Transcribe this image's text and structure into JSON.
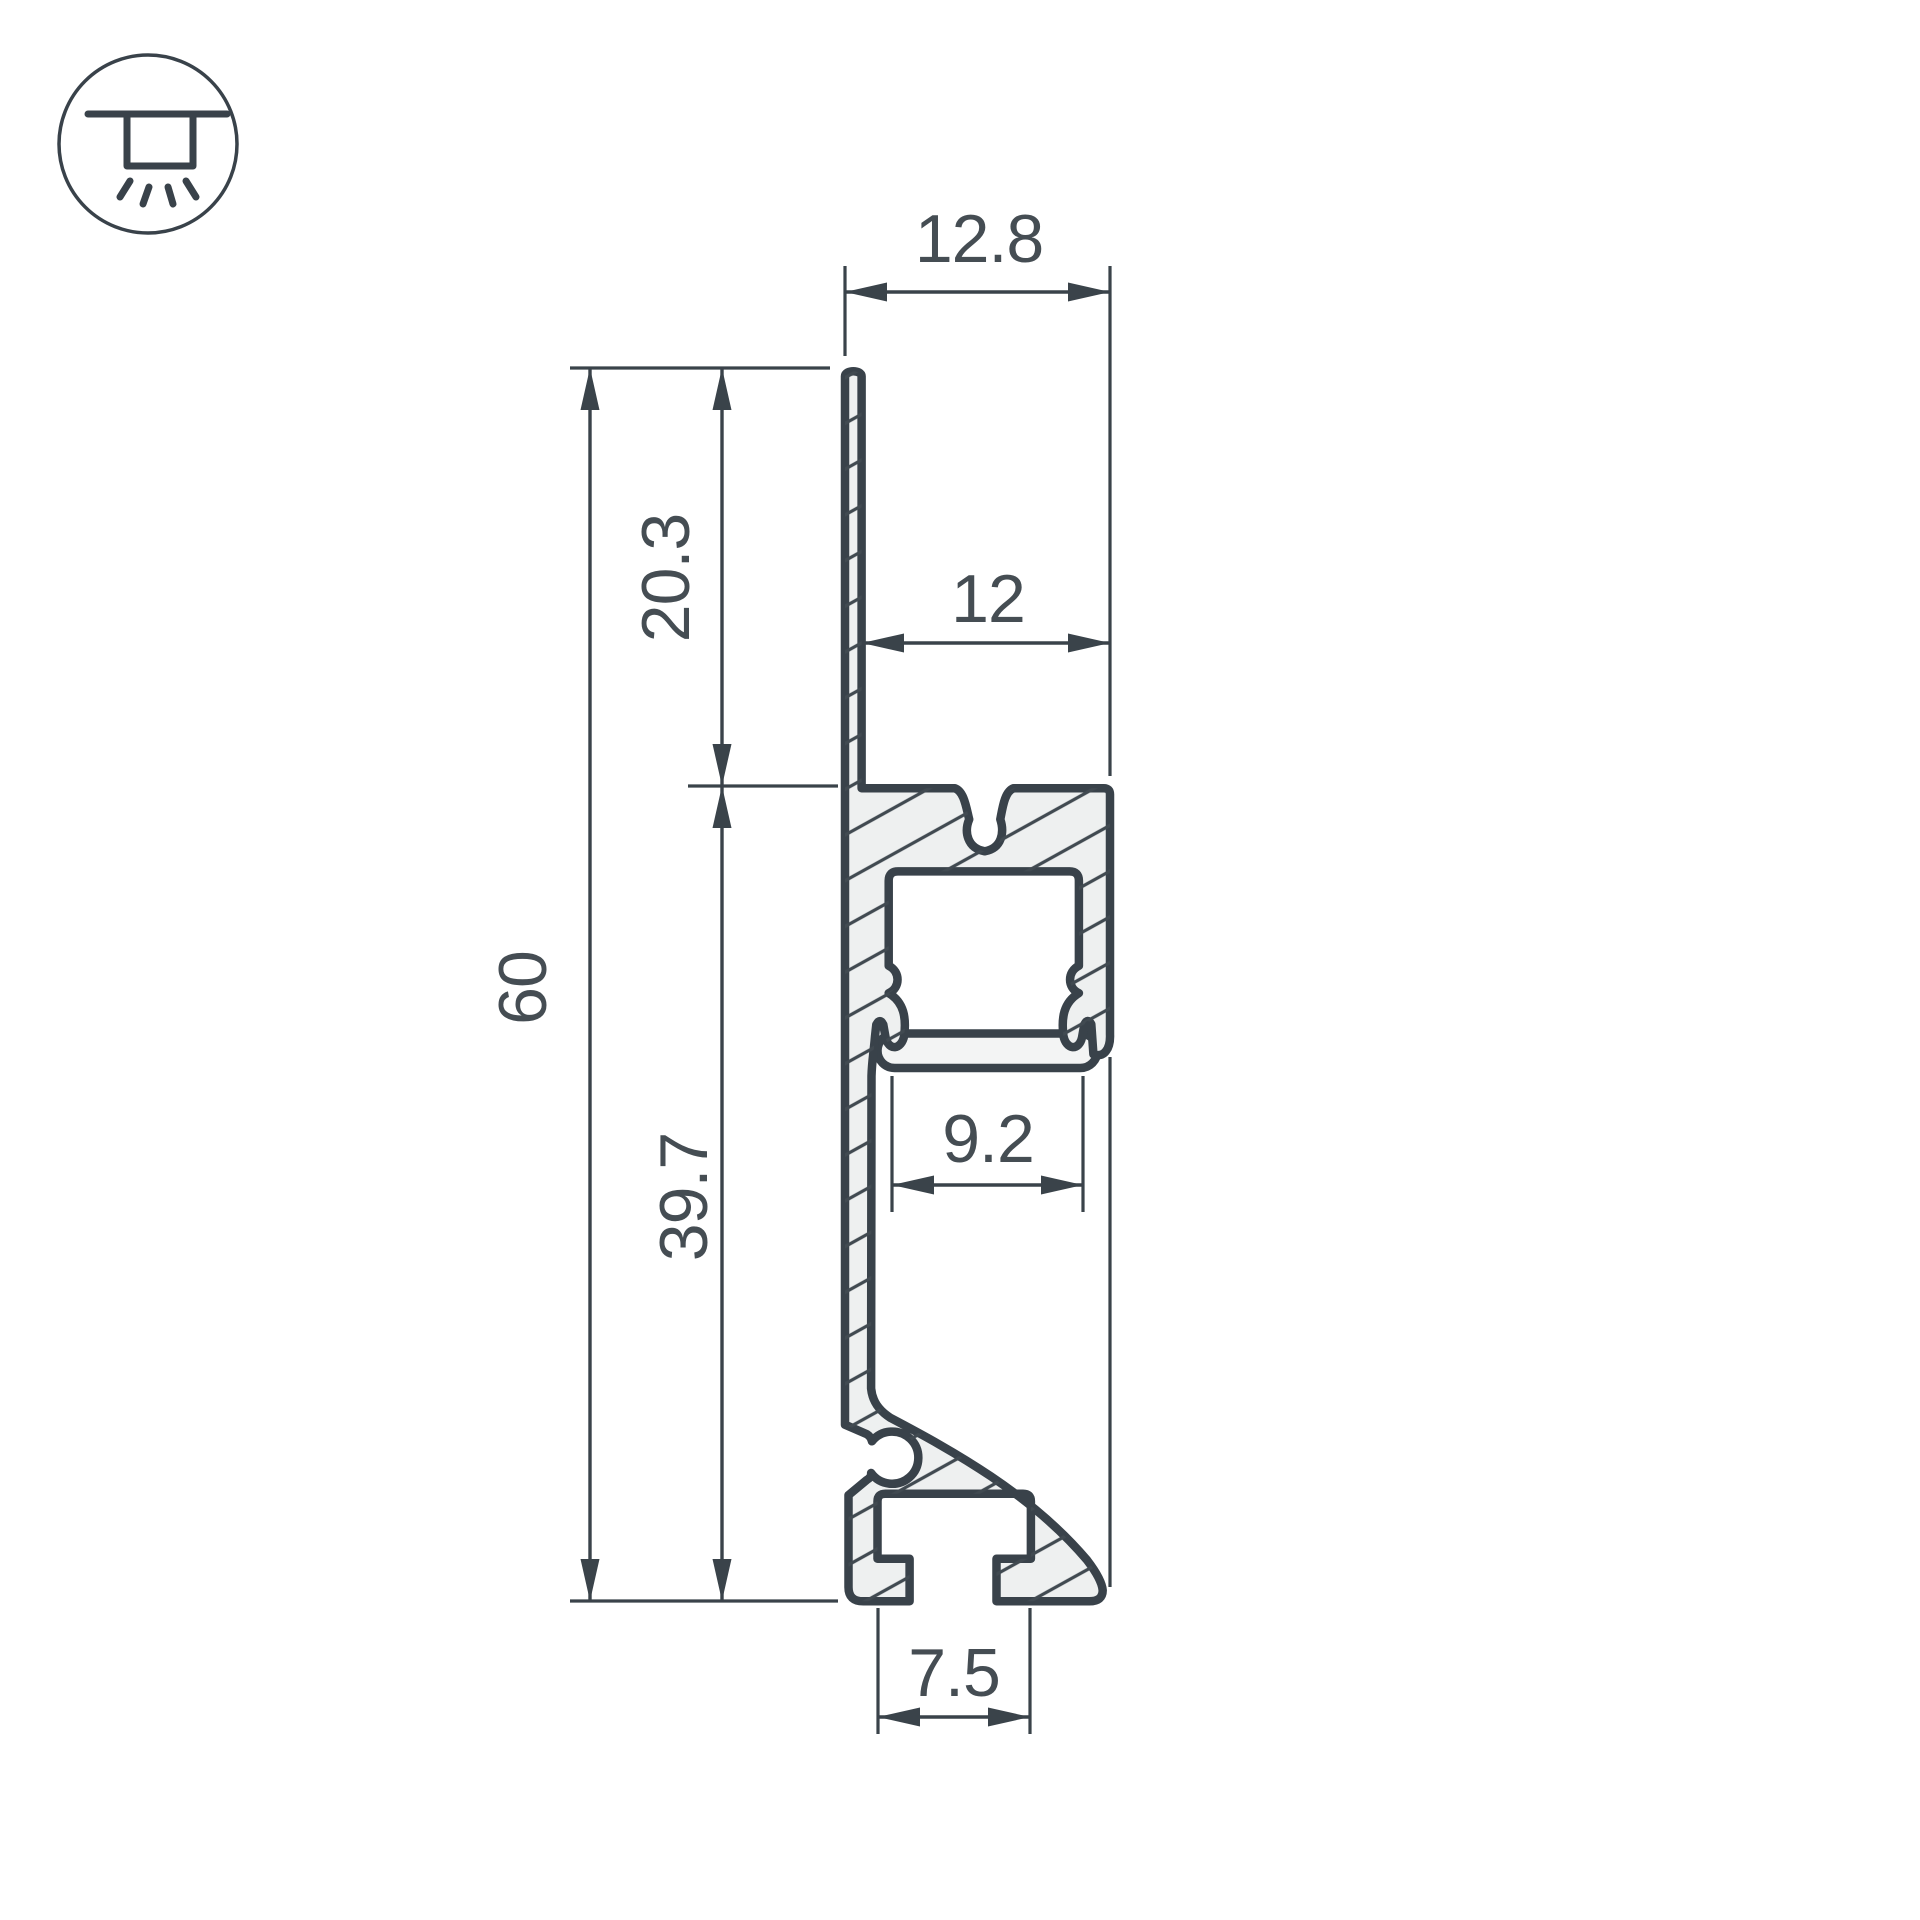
{
  "meta": {
    "type": "technical-drawing",
    "subject": "aluminium LED plinth profile cross-section"
  },
  "colors": {
    "ink": "#3a434a",
    "body_fill": "#eef0f0",
    "diffuser_fill": "#f3f4f4",
    "text": "#454d53",
    "background": "#ffffff"
  },
  "icon": {
    "name": "recessed-downlight-icon",
    "meaning": "downward light emission"
  },
  "dims": {
    "overall_width": "12.8",
    "channel_top_width": "12",
    "overall_height": "60",
    "upper_height": "20.3",
    "lower_height": "39.7",
    "channel_inner_width": "9.2",
    "foot_slot_width": "7.5"
  },
  "dimensions_mm": [
    12.8,
    12,
    60,
    20.3,
    39.7,
    9.2,
    7.5
  ]
}
